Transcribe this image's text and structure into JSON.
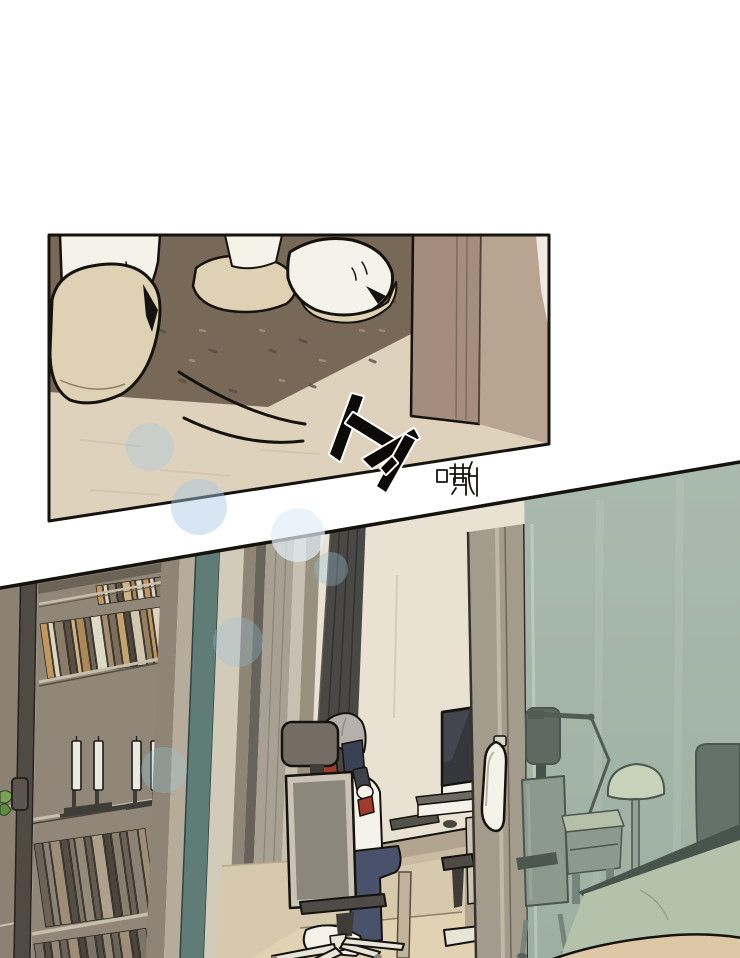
{
  "page": {
    "kind": "comic page with two panels",
    "panel1_description": "close-up of slippers on a brown rug beside a door",
    "panel2_description": "study room with person on phone in office chair seen past glass sliding doors"
  },
  "panels": [
    {
      "name": "panel-entryway-slippers",
      "sfx": [
        {
          "text": "トァ"
        },
        {
          "text": "嘶"
        }
      ]
    },
    {
      "name": "panel-study-room",
      "sfx": []
    }
  ],
  "palette": {
    "ink": "#16130f",
    "p1floor": "#dfd2bd",
    "carpet": "#786858",
    "doorframe": "#a58d7d",
    "doorframe2": "#b9a491",
    "white": "#f5f2ea",
    "cream": "#ded1b4",
    "wall": "#e9e2d3",
    "floor2": "#d7c9ad",
    "mat": "#e3d4b4",
    "backpanel": "#94887a",
    "shelfedge": "#cfc5b2",
    "framedark": "#4f4a43",
    "framegray": "#8e8576",
    "framelight": "#b5ac9c",
    "teal": "#5f7d76",
    "cream2": "#d2cbba",
    "olive": "#67625a",
    "lightgray": "#a8a092",
    "curtain": "#4a4845",
    "sliver": "#8d8173",
    "plant": "#79a258",
    "plant2": "#5e8a44",
    "stand": "#3c3733",
    "desktop": "#b2a48f",
    "deskfront": "#c8baa3",
    "screen": "#36363d",
    "phone": "#3f4148",
    "headrest": "#756c64",
    "chairmid": "#8c867b",
    "chairlight": "#cbc4b6",
    "chairdark": "#4e4a45",
    "chairbase": "#e8e4d7",
    "hair": "#b5b1aa",
    "red": "#a03a2b",
    "navy": "#3a4152",
    "denim": "#48526b",
    "glasstop": "#aabbae",
    "glassbot": "#9db0a2",
    "glassobj": "#8b9a8d",
    "glassdark": "#5d6961",
    "glassleg": "#76857a",
    "glassline": "#4a564e",
    "lampdome": "#c7d2bb",
    "headboard": "#64736a",
    "bedtop": "#b4c2ab",
    "bededge": "#46564c",
    "wedge": "#dcc8a6"
  },
  "bookshelf": {
    "rows": [
      {
        "target": "books-row-1",
        "len": 64,
        "h": 19,
        "widths": [
          6,
          4,
          7,
          5,
          8,
          4,
          6
        ],
        "colors": [
          "#c9995e",
          "#e7dcc6",
          "#8c7c69",
          "#584c40",
          "#d8b88a",
          "#b08a55",
          "#e9e1cf"
        ]
      },
      {
        "target": "books-row-2",
        "len": 118,
        "h": 55,
        "widths": [
          7,
          5,
          9,
          6,
          4,
          8,
          5,
          10,
          6,
          7
        ],
        "colors": [
          "#c9995e",
          "#e7dcc6",
          "#8c7c69",
          "#584c40",
          "#d8b88a",
          "#b08a55",
          "#6f6253",
          "#e9e1cf",
          "#a89071",
          "#7d6d5a",
          "#caa66e",
          "#4e443a",
          "#d9cdb4",
          "#97805f"
        ]
      },
      {
        "target": "books-row-3",
        "len": 112,
        "h": 84,
        "widths": [
          8,
          6,
          10,
          7,
          5,
          9,
          6,
          11,
          7
        ],
        "colors": [
          "#6b6156",
          "#8e8376",
          "#a39078",
          "#554a3f",
          "#7d7366",
          "#978b7b",
          "#645a4e",
          "#b3a38c",
          "#4a4138",
          "#89806f"
        ]
      },
      {
        "target": "books-row-4",
        "len": 110,
        "h": 34,
        "widths": [
          9,
          6,
          8,
          7,
          10,
          6
        ],
        "colors": [
          "#7d7366",
          "#554a3f",
          "#978b7b",
          "#6b6156",
          "#a39078",
          "#4a4138"
        ]
      }
    ],
    "candles": {
      "xs": [
        72,
        94,
        132,
        151
      ],
      "y": 741,
      "w": 9,
      "h": 49
    }
  },
  "bokeh": [
    {
      "cx": 150,
      "cy": 447,
      "r": 24,
      "color": "rgba(166,200,226,0.38)"
    },
    {
      "cx": 199,
      "cy": 507,
      "r": 28,
      "color": "rgba(166,200,226,0.45)"
    },
    {
      "cx": 298,
      "cy": 535,
      "r": 27,
      "color": "rgba(226,238,248,0.70)"
    },
    {
      "cx": 331,
      "cy": 569,
      "r": 17,
      "color": "rgba(150,196,216,0.35)"
    },
    {
      "cx": 238,
      "cy": 642,
      "r": 25,
      "color": "rgba(150,196,220,0.30)"
    },
    {
      "cx": 164,
      "cy": 770,
      "r": 23,
      "color": "rgba(150,200,220,0.30)"
    }
  ]
}
